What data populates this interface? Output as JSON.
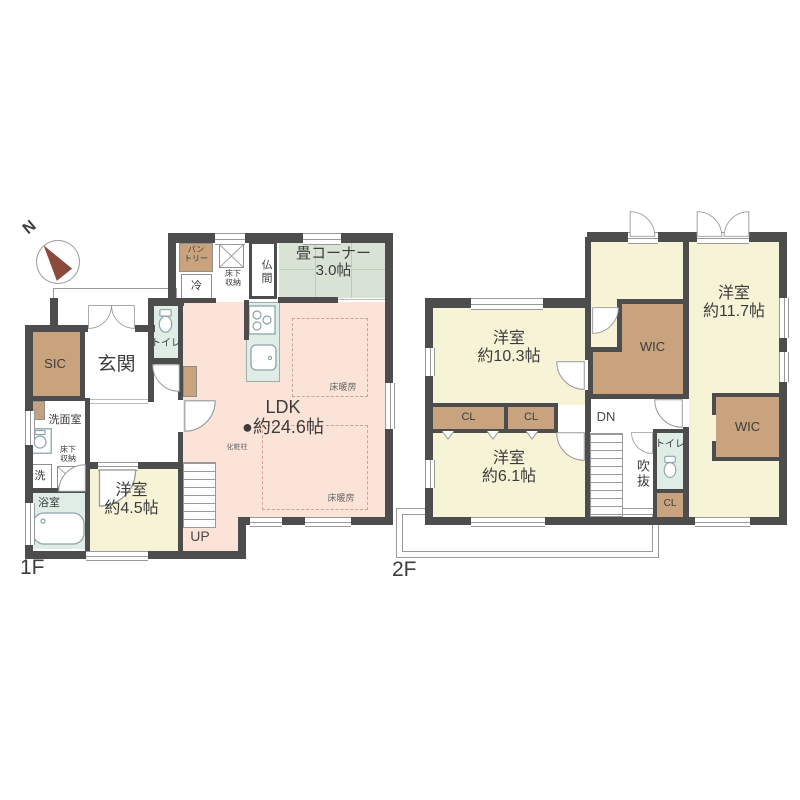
{
  "theme": {
    "wall": "#4d4d4d",
    "ink": "#3c3c3c",
    "line": "#9a9a9a",
    "tan": "#c8a37d",
    "yellow": "#f7f3d6",
    "pink": "#fbe3d8",
    "tatami": "#d8e3d5",
    "tatamiline": "#b9cdb9",
    "aqua": "#dfede6",
    "heatline": "#cfa193"
  },
  "compass": {
    "north_label": "N"
  },
  "floor1": {
    "label": "1F",
    "rooms": {
      "pantry_l1": "パン",
      "pantry_l2": "トリー",
      "fridge": "冷",
      "storage_top_l1": "床下",
      "storage_top_l2": "収納",
      "butsuma": "仏間",
      "tatami_name": "畳コーナー",
      "tatami_size": "3.0帖",
      "toilet": "トイレ",
      "genkan": "玄関",
      "sic": "SIC",
      "washroom": "洗面室",
      "storage_left_l1": "床下",
      "storage_left_l2": "収納",
      "laundry": "洗",
      "bath": "浴室",
      "bedroom_name": "洋室",
      "bedroom_size": "約4.5帖",
      "ldk_name": "LDK",
      "ldk_marker": "●",
      "ldk_size": "約24.6帖",
      "pillar": "化粧柱",
      "floor_heating": "床暖房",
      "stairs_up": "UP"
    }
  },
  "floor2": {
    "label": "2F",
    "rooms": {
      "bedroom103_name": "洋室",
      "bedroom103_size": "約10.3帖",
      "bedroom117_name": "洋室",
      "bedroom117_size": "約11.7帖",
      "bedroom61_name": "洋室",
      "bedroom61_size": "約6.1帖",
      "wic_left": "WIC",
      "wic_right": "WIC",
      "cl_a": "CL",
      "cl_b": "CL",
      "cl_c": "CL",
      "stairs_down": "DN",
      "void": "吹抜",
      "toilet": "トイレ"
    }
  }
}
